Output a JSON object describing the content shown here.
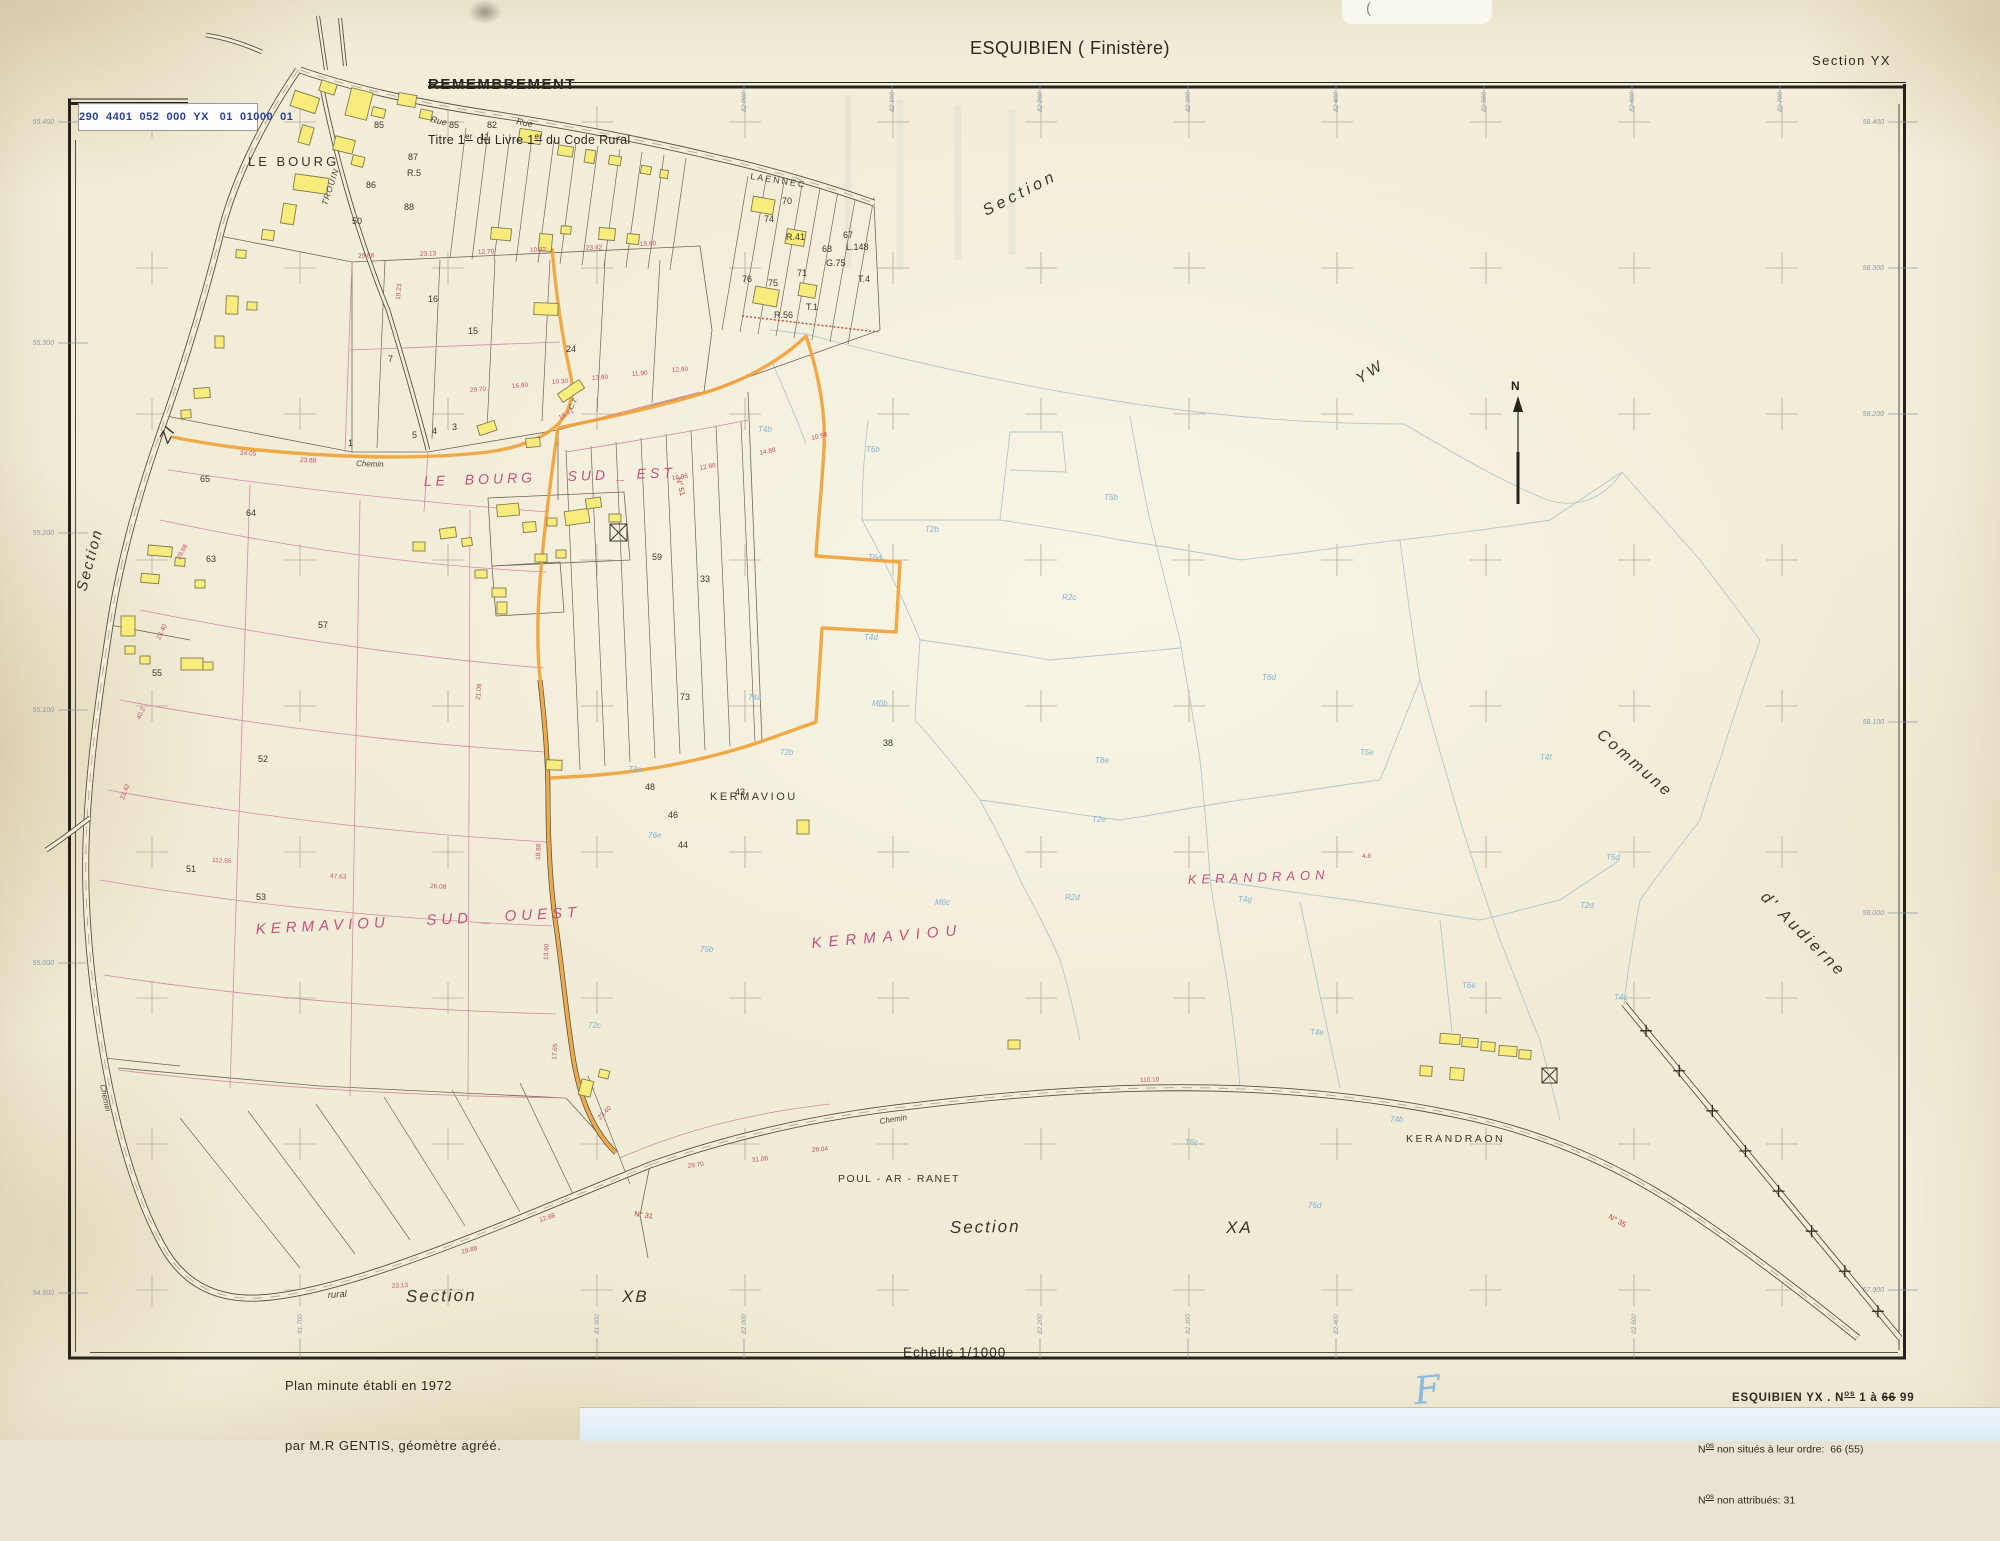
{
  "header": {
    "stamp": "290  4401  052  000  YX   01  01000  01",
    "remembrement": "REMEMBREMENT",
    "titre": {
      "pre": "Titre 1",
      "sup1": "er",
      "mid": " du Livre 1",
      "sup2": "er",
      "post": " du Code Rural"
    },
    "title": "ESQUIBIEN ( Finistère)",
    "section": "Section YX"
  },
  "footer": {
    "plan_line1": "Plan minute établi en 1972",
    "plan_line2": "par M.R GENTIS, géomètre agréé.",
    "scale": "Echelle 1/1000",
    "sheet_note": {
      "l1_pre": "ESQUIBIEN YX . N",
      "l1_sup": "os",
      "l1_mid": " 1 à ",
      "l1_struck": "66",
      "l1_post": " 99",
      "l2_pre": "N",
      "l2_sup": "os",
      "l2_rest": " non situés à leur ordre:  66 (55)",
      "l3_pre": "N",
      "l3_sup": "os",
      "l3_rest": " non attribués: 31"
    },
    "hand_mark": "F",
    "pen_mark": "("
  },
  "map": {
    "north_label": "N",
    "colors": {
      "building": "#f8ec7d",
      "boundary_orange": "#f0a33b",
      "pink": "#c4527e",
      "blue_code": "#84b4d8",
      "ink": "#3b362c",
      "dim": "#c0506e",
      "road_no": "#c03a35"
    },
    "place_labels": [
      {
        "id": "le-bourg",
        "text": "LE BOURG",
        "x": 248,
        "y": 166,
        "size": 13,
        "rot": 0,
        "ls": 3,
        "color": "ink",
        "italic": false
      },
      {
        "id": "le-bourg-sud-est",
        "text": "LE  BOURG    SUD _ EST",
        "x": 424,
        "y": 486,
        "size": 14,
        "rot": -2,
        "ls": 4,
        "color": "pink",
        "italic": true
      },
      {
        "id": "kermaviou-black",
        "text": "KERMAVIOU",
        "x": 710,
        "y": 800,
        "size": 11,
        "rot": 0,
        "ls": 2.5,
        "color": "ink",
        "italic": false
      },
      {
        "id": "kermaviou-pink",
        "text": "KERMAVIOU",
        "x": 812,
        "y": 948,
        "size": 15,
        "rot": -5,
        "ls": 7,
        "color": "pink",
        "italic": true
      },
      {
        "id": "kermaviou-sud-ouest",
        "text": "KERMAVIOU    SUD _ OUEST",
        "x": 256,
        "y": 934,
        "size": 15,
        "rot": -3,
        "ls": 5,
        "color": "pink",
        "italic": true
      },
      {
        "id": "kerandraon-pink",
        "text": "KERANDRAON",
        "x": 1188,
        "y": 884,
        "size": 13,
        "rot": -2,
        "ls": 5,
        "color": "pink",
        "italic": true
      },
      {
        "id": "kerandraon-black",
        "text": "KERANDRAON",
        "x": 1406,
        "y": 1142,
        "size": 10.5,
        "rot": 0,
        "ls": 2.5,
        "color": "ink",
        "italic": false
      },
      {
        "id": "poul-ar-ranet",
        "text": "POUL - AR - RANET",
        "x": 838,
        "y": 1182,
        "size": 10.5,
        "rot": 0,
        "ls": 1.5,
        "color": "ink",
        "italic": false
      },
      {
        "id": "section-xb",
        "text": "Section",
        "x": 406,
        "y": 1302,
        "size": 17,
        "rot": -1,
        "ls": 2,
        "color": "ink",
        "italic": true
      },
      {
        "id": "xb",
        "text": "XB",
        "x": 622,
        "y": 1302,
        "size": 17,
        "rot": 0,
        "ls": 2,
        "color": "ink",
        "italic": true
      },
      {
        "id": "section-xa",
        "text": "Section",
        "x": 950,
        "y": 1233,
        "size": 17,
        "rot": -1,
        "ls": 2,
        "color": "ink",
        "italic": true
      },
      {
        "id": "xa",
        "text": "XA",
        "x": 1226,
        "y": 1233,
        "size": 17,
        "rot": 0,
        "ls": 2,
        "color": "ink",
        "italic": true
      },
      {
        "id": "section-top",
        "text": "Section",
        "x": 986,
        "y": 216,
        "size": 16,
        "rot": -27,
        "ls": 4,
        "color": "ink",
        "italic": true
      },
      {
        "id": "yw",
        "text": "YW",
        "x": 1360,
        "y": 384,
        "size": 15,
        "rot": -33,
        "ls": 3,
        "color": "ink",
        "italic": true
      },
      {
        "id": "section-left",
        "text": "Section",
        "x": 86,
        "y": 592,
        "size": 15,
        "rot": -75,
        "ls": 2,
        "color": "ink",
        "italic": true
      },
      {
        "id": "zi",
        "text": "ZI",
        "x": 168,
        "y": 444,
        "size": 16,
        "rot": -62,
        "ls": 1,
        "color": "ink",
        "italic": true
      },
      {
        "id": "commune",
        "text": "Commune",
        "x": 1596,
        "y": 736,
        "size": 16,
        "rot": 41,
        "ls": 3,
        "color": "ink",
        "italic": true
      },
      {
        "id": "d-audierne",
        "text": "d' Audierne",
        "x": 1760,
        "y": 898,
        "size": 16,
        "rot": 45,
        "ls": 3,
        "color": "ink",
        "italic": true
      }
    ],
    "street_labels": [
      {
        "id": "rue-1",
        "text": "Rue",
        "x": 430,
        "y": 122,
        "size": 9,
        "rot": 13,
        "italic": true
      },
      {
        "id": "rue-2",
        "text": "Rue",
        "x": 516,
        "y": 124,
        "size": 9,
        "rot": 11,
        "italic": true
      },
      {
        "id": "laennec",
        "text": "LAENNEC",
        "x": 750,
        "y": 179,
        "size": 9,
        "rot": 9,
        "ls": 2,
        "italic": false
      },
      {
        "id": "trouin",
        "text": "TROUIN",
        "x": 327,
        "y": 206,
        "size": 8.5,
        "rot": -72,
        "ls": 1,
        "italic": true
      },
      {
        "id": "chemin-1",
        "text": "Chemin",
        "x": 356,
        "y": 466,
        "size": 8,
        "rot": 2,
        "italic": true
      },
      {
        "id": "ct",
        "text": "C.T.",
        "x": 572,
        "y": 410,
        "size": 7,
        "rot": -60,
        "italic": true
      },
      {
        "id": "chemin-2",
        "text": "Chemin",
        "x": 880,
        "y": 1124,
        "size": 8,
        "rot": -9,
        "italic": true
      },
      {
        "id": "rural",
        "text": "rural",
        "x": 328,
        "y": 1298,
        "size": 9.5,
        "rot": -4,
        "italic": true
      },
      {
        "id": "chemin-3",
        "text": "Chemin",
        "x": 100,
        "y": 1085,
        "size": 8,
        "rot": 78,
        "italic": true
      }
    ],
    "parcel_numbers": [
      {
        "t": "85",
        "x": 374,
        "y": 128
      },
      {
        "t": "85",
        "x": 449,
        "y": 128
      },
      {
        "t": "82",
        "x": 487,
        "y": 128
      },
      {
        "t": "87",
        "x": 408,
        "y": 160
      },
      {
        "t": "R.5",
        "x": 407,
        "y": 176
      },
      {
        "t": "88",
        "x": 404,
        "y": 210
      },
      {
        "t": "86",
        "x": 366,
        "y": 188
      },
      {
        "t": "50",
        "x": 352,
        "y": 224
      },
      {
        "t": "11",
        "x": 480,
        "y": 140
      },
      {
        "t": "70",
        "x": 782,
        "y": 204
      },
      {
        "t": "74",
        "x": 764,
        "y": 222
      },
      {
        "t": "67",
        "x": 843,
        "y": 238
      },
      {
        "t": "68",
        "x": 822,
        "y": 252
      },
      {
        "t": "G.75",
        "x": 826,
        "y": 266
      },
      {
        "t": "71",
        "x": 797,
        "y": 276
      },
      {
        "t": "75",
        "x": 768,
        "y": 286
      },
      {
        "t": "76",
        "x": 742,
        "y": 282
      },
      {
        "t": "R.41",
        "x": 786,
        "y": 240
      },
      {
        "t": "R.56",
        "x": 774,
        "y": 318
      },
      {
        "t": "T.1",
        "x": 806,
        "y": 310
      },
      {
        "t": "L.148",
        "x": 846,
        "y": 250
      },
      {
        "t": "T.4",
        "x": 858,
        "y": 282
      },
      {
        "t": "15",
        "x": 468,
        "y": 334
      },
      {
        "t": "16",
        "x": 428,
        "y": 302
      },
      {
        "t": "24",
        "x": 566,
        "y": 352
      },
      {
        "t": "7",
        "x": 388,
        "y": 362
      },
      {
        "t": "5",
        "x": 412,
        "y": 438
      },
      {
        "t": "4",
        "x": 432,
        "y": 434
      },
      {
        "t": "3",
        "x": 452,
        "y": 430
      },
      {
        "t": "1",
        "x": 348,
        "y": 446
      },
      {
        "t": "65",
        "x": 200,
        "y": 482
      },
      {
        "t": "64",
        "x": 246,
        "y": 516
      },
      {
        "t": "63",
        "x": 206,
        "y": 562
      },
      {
        "t": "57",
        "x": 318,
        "y": 628
      },
      {
        "t": "52",
        "x": 258,
        "y": 762
      },
      {
        "t": "51",
        "x": 186,
        "y": 872
      },
      {
        "t": "55",
        "x": 152,
        "y": 676
      },
      {
        "t": "53",
        "x": 256,
        "y": 900
      },
      {
        "t": "59",
        "x": 652,
        "y": 560
      },
      {
        "t": "33",
        "x": 700,
        "y": 582
      },
      {
        "t": "43",
        "x": 735,
        "y": 795
      },
      {
        "t": "46",
        "x": 668,
        "y": 818
      },
      {
        "t": "44",
        "x": 678,
        "y": 848
      },
      {
        "t": "48",
        "x": 645,
        "y": 790
      },
      {
        "t": "38",
        "x": 883,
        "y": 746
      },
      {
        "t": "73",
        "x": 680,
        "y": 700
      }
    ],
    "blue_codes": [
      {
        "t": "T4b",
        "x": 758,
        "y": 432
      },
      {
        "t": "T6b",
        "x": 866,
        "y": 452
      },
      {
        "t": "T2b",
        "x": 925,
        "y": 532
      },
      {
        "t": "T5b",
        "x": 1104,
        "y": 500
      },
      {
        "t": "R2c",
        "x": 1062,
        "y": 600
      },
      {
        "t": "T4d",
        "x": 864,
        "y": 640
      },
      {
        "t": "M6b",
        "x": 872,
        "y": 706
      },
      {
        "t": "72b",
        "x": 780,
        "y": 755
      },
      {
        "t": "74a",
        "x": 748,
        "y": 700
      },
      {
        "t": "T4g",
        "x": 1238,
        "y": 902
      },
      {
        "t": "T5d",
        "x": 1606,
        "y": 860
      },
      {
        "t": "T2d",
        "x": 1580,
        "y": 908
      },
      {
        "t": "T4c",
        "x": 1614,
        "y": 1000
      },
      {
        "t": "T6c",
        "x": 1185,
        "y": 1145
      },
      {
        "t": "T4e",
        "x": 1310,
        "y": 1035
      },
      {
        "t": "T6e",
        "x": 1462,
        "y": 988
      },
      {
        "t": "T2e",
        "x": 1092,
        "y": 822
      },
      {
        "t": "M6c",
        "x": 935,
        "y": 905
      },
      {
        "t": "T5e",
        "x": 1360,
        "y": 755
      },
      {
        "t": "R2d",
        "x": 1065,
        "y": 900
      },
      {
        "t": "74b",
        "x": 1390,
        "y": 1122
      },
      {
        "t": "76d",
        "x": 1308,
        "y": 1208
      },
      {
        "t": "76e",
        "x": 648,
        "y": 838
      },
      {
        "t": "73a",
        "x": 628,
        "y": 772
      },
      {
        "t": "75b",
        "x": 700,
        "y": 952
      },
      {
        "t": "72c",
        "x": 588,
        "y": 1028
      },
      {
        "t": "T8e",
        "x": 1095,
        "y": 763
      },
      {
        "t": "T6a",
        "x": 868,
        "y": 560
      },
      {
        "t": "T4f",
        "x": 1540,
        "y": 760
      },
      {
        "t": "T6d",
        "x": 1262,
        "y": 680
      }
    ],
    "dimensions": [
      {
        "t": "29.88",
        "x": 358,
        "y": 258,
        "r": -2
      },
      {
        "t": "23.13",
        "x": 420,
        "y": 256,
        "r": -2
      },
      {
        "t": "12.70",
        "x": 478,
        "y": 254,
        "r": -2
      },
      {
        "t": "10.92",
        "x": 530,
        "y": 252,
        "r": -2
      },
      {
        "t": "23.42",
        "x": 586,
        "y": 250,
        "r": -3
      },
      {
        "t": "15.60",
        "x": 640,
        "y": 246,
        "r": -3
      },
      {
        "t": "19.23",
        "x": 400,
        "y": 300,
        "r": -85
      },
      {
        "t": "29.70",
        "x": 470,
        "y": 392,
        "r": -4
      },
      {
        "t": "16.90",
        "x": 512,
        "y": 388,
        "r": -4
      },
      {
        "t": "10.30",
        "x": 552,
        "y": 384,
        "r": -4
      },
      {
        "t": "13.90",
        "x": 592,
        "y": 380,
        "r": -4
      },
      {
        "t": "11.90",
        "x": 632,
        "y": 376,
        "r": -4
      },
      {
        "t": "12.90",
        "x": 672,
        "y": 372,
        "r": -4
      },
      {
        "t": "23.88",
        "x": 300,
        "y": 462,
        "r": 2
      },
      {
        "t": "24.05",
        "x": 240,
        "y": 455,
        "r": 2
      },
      {
        "t": "29.88",
        "x": 180,
        "y": 560,
        "r": -62
      },
      {
        "t": "23.40",
        "x": 160,
        "y": 640,
        "r": -65
      },
      {
        "t": "40.2",
        "x": 140,
        "y": 720,
        "r": -65
      },
      {
        "t": "23.42",
        "x": 124,
        "y": 800,
        "r": -70
      },
      {
        "t": "112.55",
        "x": 212,
        "y": 862,
        "r": 3
      },
      {
        "t": "47.63",
        "x": 330,
        "y": 878,
        "r": 3
      },
      {
        "t": "26.08",
        "x": 430,
        "y": 888,
        "r": 3
      },
      {
        "t": "28.04",
        "x": 812,
        "y": 1152,
        "r": -5
      },
      {
        "t": "31.08",
        "x": 752,
        "y": 1162,
        "r": -6
      },
      {
        "t": "29.70",
        "x": 688,
        "y": 1168,
        "r": -8
      },
      {
        "t": "18.41",
        "x": 560,
        "y": 420,
        "r": -30
      },
      {
        "t": "23.13",
        "x": 392,
        "y": 1288,
        "r": -4
      },
      {
        "t": "29.88",
        "x": 462,
        "y": 1254,
        "r": -15
      },
      {
        "t": "12.88",
        "x": 540,
        "y": 1222,
        "r": -18
      },
      {
        "t": "21.08",
        "x": 480,
        "y": 700,
        "r": -85
      },
      {
        "t": "18.88",
        "x": 540,
        "y": 860,
        "r": -88
      },
      {
        "t": "13.90",
        "x": 548,
        "y": 960,
        "r": -88
      },
      {
        "t": "17.65",
        "x": 556,
        "y": 1060,
        "r": -85
      },
      {
        "t": "23.40",
        "x": 600,
        "y": 1120,
        "r": -45
      },
      {
        "t": "12.88",
        "x": 700,
        "y": 470,
        "r": -10
      },
      {
        "t": "14.88",
        "x": 760,
        "y": 455,
        "r": -12
      },
      {
        "t": "10.98",
        "x": 812,
        "y": 440,
        "r": -14
      },
      {
        "t": "16.98",
        "x": 672,
        "y": 480,
        "r": -8
      },
      {
        "t": "110.10",
        "x": 1140,
        "y": 1082,
        "r": -2
      },
      {
        "t": "4.8",
        "x": 1362,
        "y": 858,
        "r": 0
      }
    ],
    "road_numbers": [
      {
        "t": "N° 51",
        "x": 676,
        "y": 478,
        "r": 76
      },
      {
        "t": "N° 31",
        "x": 634,
        "y": 1216,
        "r": 8
      },
      {
        "t": "N° 35",
        "x": 1608,
        "y": 1218,
        "r": 30
      }
    ],
    "coord_ticks": {
      "left": [
        {
          "text": "55.400",
          "y": 122
        },
        {
          "text": "55.300",
          "y": 343
        },
        {
          "text": "55.200",
          "y": 533
        },
        {
          "text": "55.100",
          "y": 710
        },
        {
          "text": "55.000",
          "y": 963
        },
        {
          "text": "54.900",
          "y": 1293
        }
      ],
      "right": [
        {
          "text": "58.400",
          "y": 122
        },
        {
          "text": "58.300",
          "y": 268
        },
        {
          "text": "58.200",
          "y": 414
        },
        {
          "text": "58.100",
          "y": 722
        },
        {
          "text": "58.000",
          "y": 913
        },
        {
          "text": "57.900",
          "y": 1290
        }
      ],
      "top": [
        {
          "text": "82.000",
          "x": 744
        },
        {
          "text": "82.100",
          "x": 892
        },
        {
          "text": "82.200",
          "x": 1040
        },
        {
          "text": "82.300",
          "x": 1188
        },
        {
          "text": "82.400",
          "x": 1336
        },
        {
          "text": "82.500",
          "x": 1484
        },
        {
          "text": "82.600",
          "x": 1632
        },
        {
          "text": "82.700",
          "x": 1780
        }
      ],
      "bottom": [
        {
          "text": "81.700",
          "x": 300
        },
        {
          "text": "81.900",
          "x": 597
        },
        {
          "text": "82.000",
          "x": 744
        },
        {
          "text": "82.200",
          "x": 1040
        },
        {
          "text": "82.300",
          "x": 1188
        },
        {
          "text": "82.400",
          "x": 1336
        },
        {
          "text": "82.600",
          "x": 1634
        }
      ]
    }
  }
}
